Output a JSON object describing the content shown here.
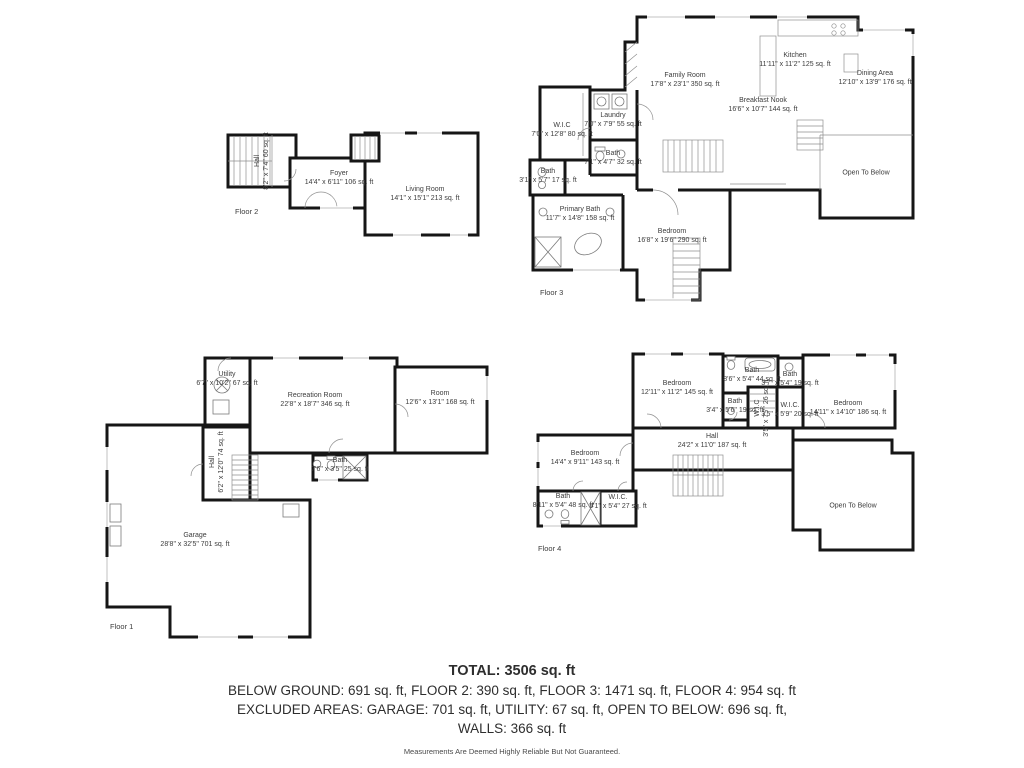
{
  "colors": {
    "wall": "#161616",
    "text": "#3c3c3c",
    "window": "#cfcfcf"
  },
  "floor1": {
    "tag": "Floor 1",
    "rooms": [
      {
        "name": "Utility",
        "dims": "6'7\" x 10'2\" 67 sq. ft"
      },
      {
        "name": "Recreation Room",
        "dims": "22'8\" x 18'7\" 346 sq. ft"
      },
      {
        "name": "Room",
        "dims": "12'6\" x 13'1\" 168 sq. ft"
      },
      {
        "name": "Hall",
        "dims": "6'2\" x 12'0\" 74 sq. ft"
      },
      {
        "name": "Bath",
        "dims": "7'6\" x 3'5\" 25 sq. ft"
      },
      {
        "name": "Garage",
        "dims": "28'8\" x 32'5\" 701 sq. ft"
      }
    ]
  },
  "floor2": {
    "tag": "Floor 2",
    "rooms": [
      {
        "name": "Hall",
        "dims": "8'2\" x 7'4\" 60 sq. ft"
      },
      {
        "name": "Foyer",
        "dims": "14'4\" x 6'11\" 106 sq. ft"
      },
      {
        "name": "Living Room",
        "dims": "14'1\" x 15'1\" 213 sq. ft"
      }
    ]
  },
  "floor3": {
    "tag": "Floor 3",
    "rooms": [
      {
        "name": "Family Room",
        "dims": "17'8\" x 23'1\" 350 sq. ft"
      },
      {
        "name": "Kitchen",
        "dims": "11'11\" x 11'2\" 125 sq. ft"
      },
      {
        "name": "Dining Area",
        "dims": "12'10\" x 13'9\" 176 sq. ft"
      },
      {
        "name": "Breakfast Nook",
        "dims": "16'6\" x 10'7\" 144 sq. ft"
      },
      {
        "name": "Laundry",
        "dims": "7'0\" x 7'9\" 55 sq. ft"
      },
      {
        "name": "W.I.C",
        "dims": "7'0\" x 12'8\" 80 sq. ft"
      },
      {
        "name": "Bath",
        "dims": "7'1\" x 4'7\" 32 sq. ft"
      },
      {
        "name": "Bath",
        "dims": "3'1\" x 5'7\" 17 sq. ft"
      },
      {
        "name": "Primary Bath",
        "dims": "11'7\" x 14'8\" 158 sq. ft"
      },
      {
        "name": "Bedroom",
        "dims": "16'8\" x 19'6\" 290 sq. ft"
      },
      {
        "name": "Open To Below",
        "dims": ""
      }
    ]
  },
  "floor4": {
    "tag": "Floor 4",
    "rooms": [
      {
        "name": "Bedroom",
        "dims": "12'11\" x 11'2\" 145 sq. ft"
      },
      {
        "name": "Bath",
        "dims": "8'6\" x 5'4\" 44 sq. ft"
      },
      {
        "name": "Bath",
        "dims": "3'7\" x 5'4\" 19 sq. ft"
      },
      {
        "name": "Bath",
        "dims": "3'4\" x 5'6\" 19 sq. ft"
      },
      {
        "name": "W.I.C",
        "dims": "3'5\" x 7'7\" 26 sq. ft"
      },
      {
        "name": "W.I.C.",
        "dims": "3'5\" x 5'9\" 20 sq. ft"
      },
      {
        "name": "Bedroom",
        "dims": "14'11\" x 14'10\" 186 sq. ft"
      },
      {
        "name": "Hall",
        "dims": "24'2\" x 11'0\" 187 sq. ft"
      },
      {
        "name": "Bedroom",
        "dims": "14'4\" x 9'11\" 143 sq. ft"
      },
      {
        "name": "Bath",
        "dims": "8'11\" x 5'4\" 48 sq. ft"
      },
      {
        "name": "W.I.C.",
        "dims": "5'1\" x 5'4\" 27 sq. ft"
      },
      {
        "name": "Open To Below",
        "dims": ""
      }
    ]
  },
  "summary": {
    "total": "TOTAL: 3506 sq. ft",
    "floors_line": "BELOW GROUND: 691 sq. ft, FLOOR 2: 390 sq. ft, FLOOR 3: 1471 sq. ft, FLOOR 4: 954 sq. ft",
    "excluded_line": "EXCLUDED AREAS: GARAGE: 701 sq. ft, UTILITY: 67 sq. ft, OPEN TO BELOW: 696 sq. ft,",
    "walls_line": "WALLS: 366 sq. ft",
    "disclaimer": "Measurements Are Deemed Highly Reliable But Not Guaranteed."
  }
}
